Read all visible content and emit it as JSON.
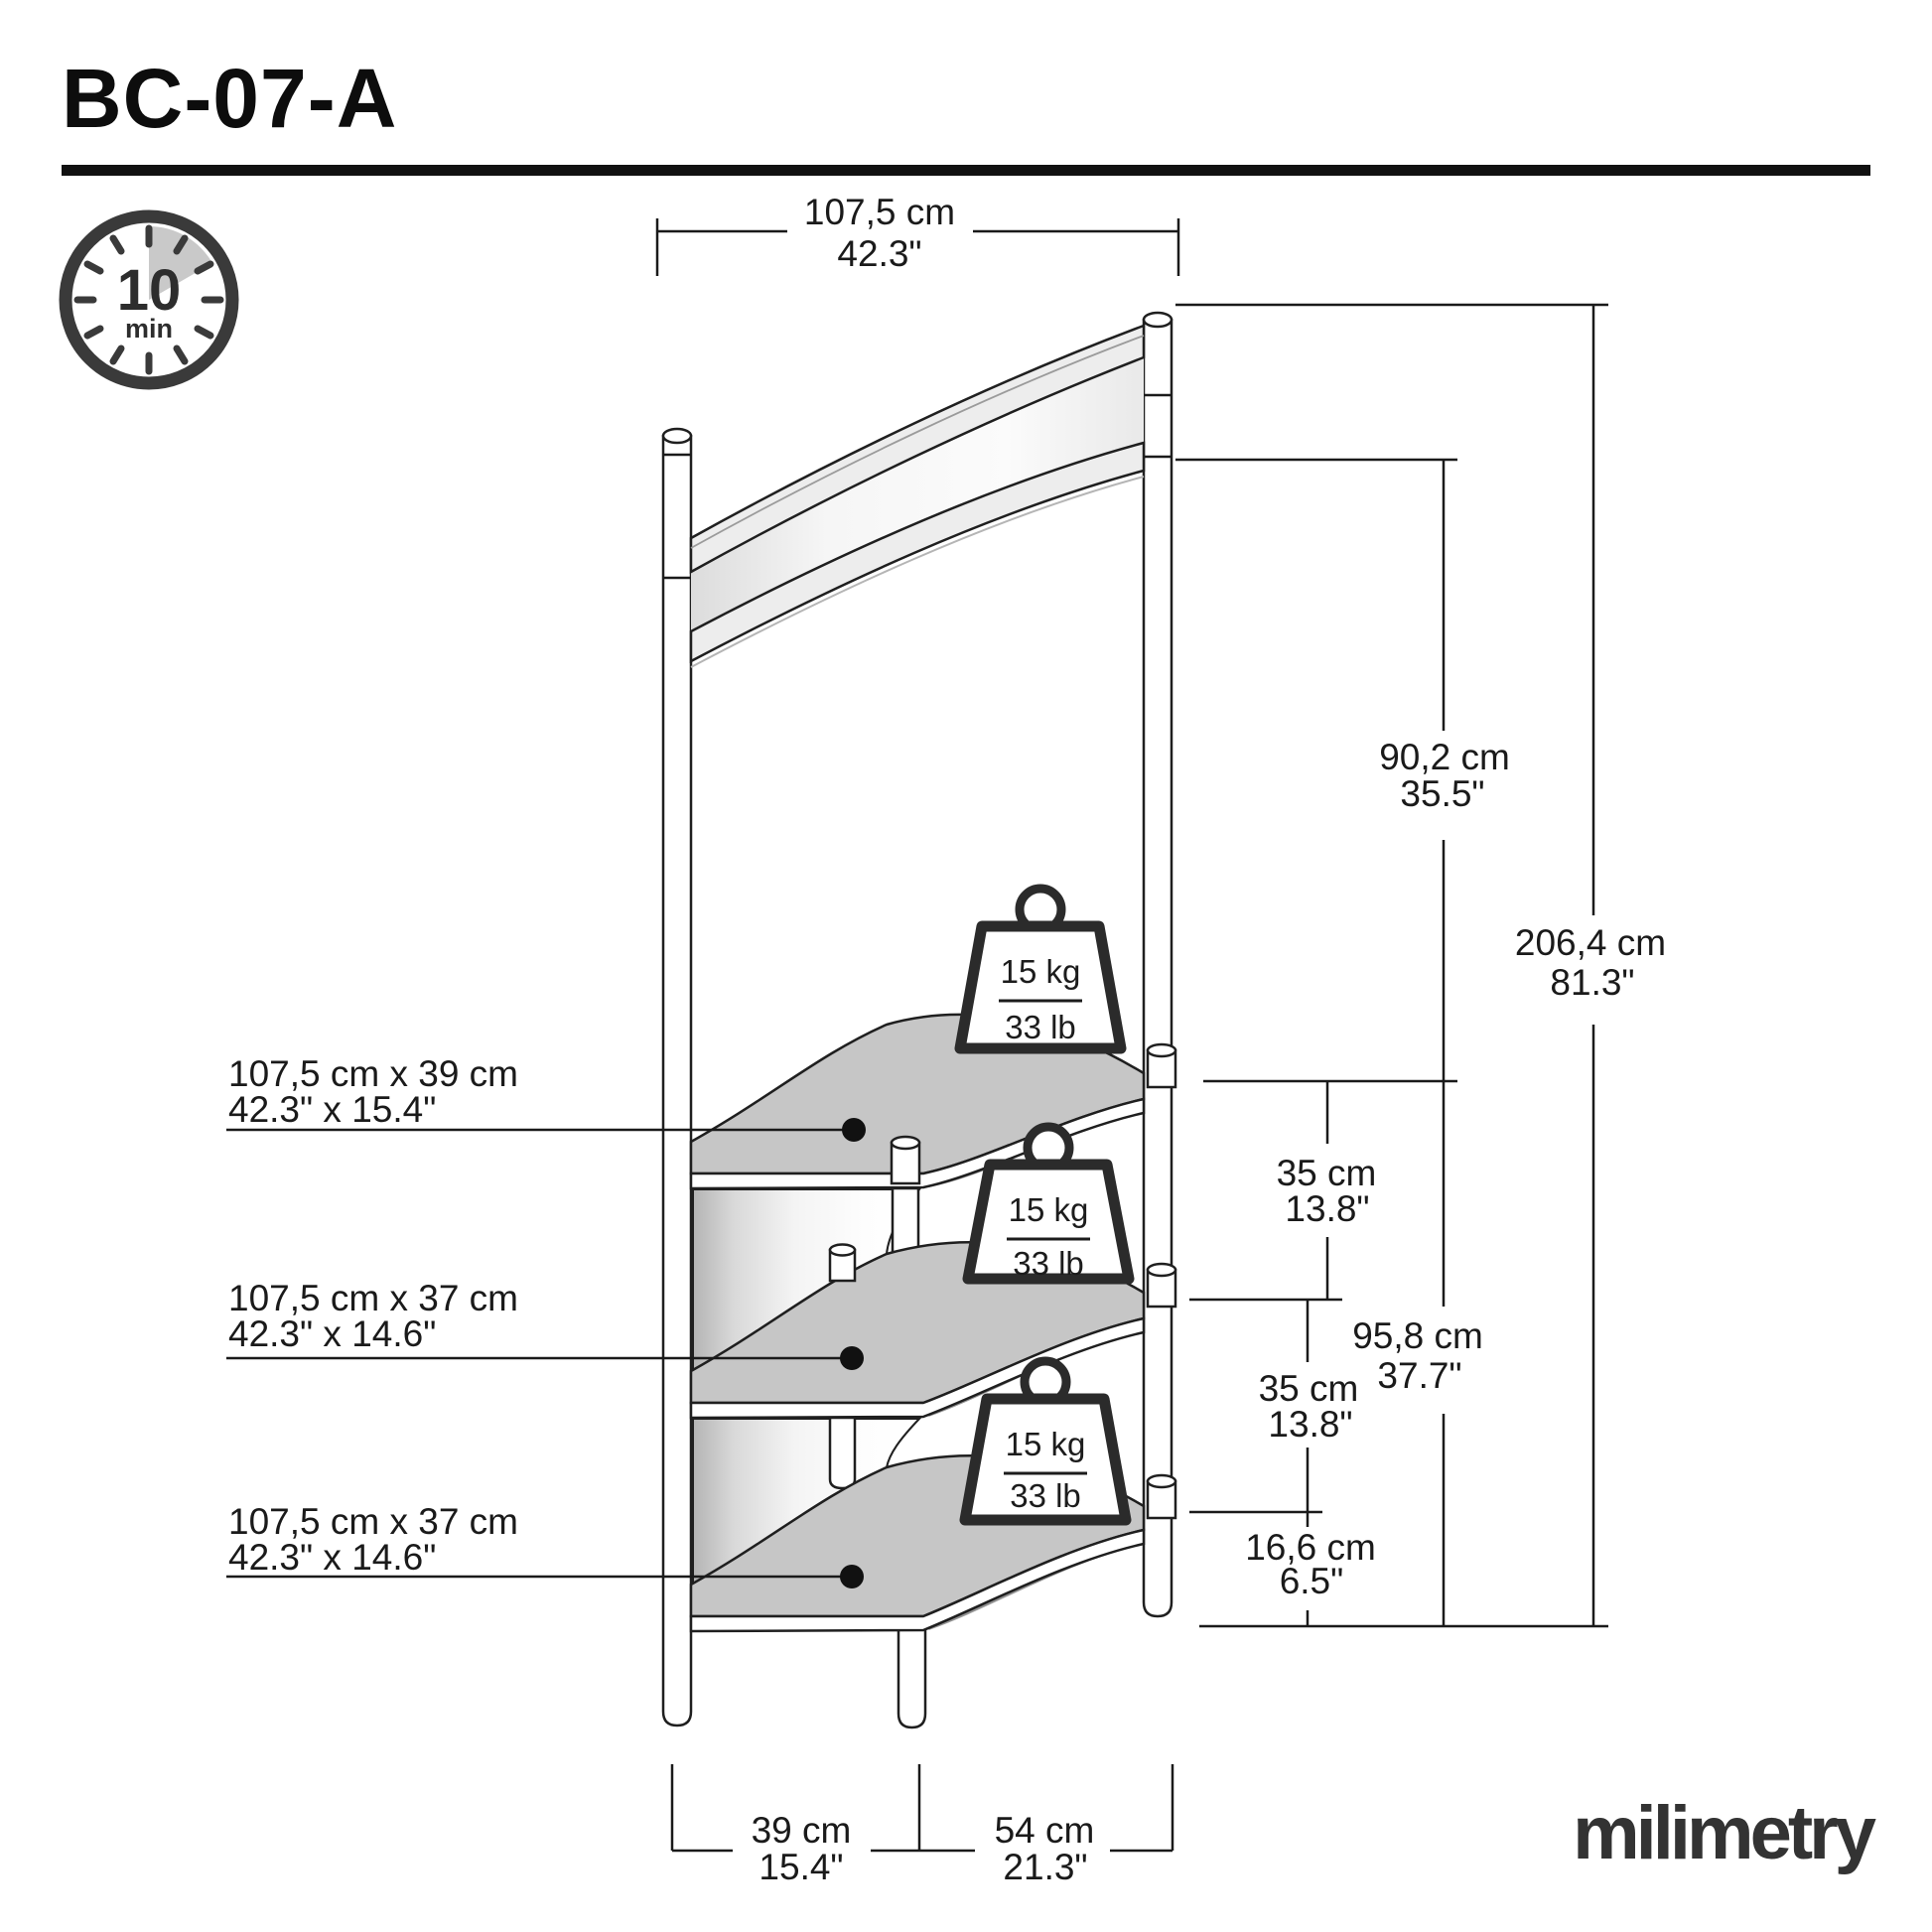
{
  "product": {
    "model": "BC-07-A"
  },
  "assembly_time": {
    "value": "10",
    "unit": "min"
  },
  "dims": {
    "width_top": {
      "cm": "107,5 cm",
      "in": "42.3\""
    },
    "height_upper": {
      "cm": "90,2 cm",
      "in": "35.5\""
    },
    "height_total": {
      "cm": "206,4 cm",
      "in": "81.3\""
    },
    "shelf_spacing_1": {
      "cm": "35 cm",
      "in": "13.8\""
    },
    "height_lower": {
      "cm": "95,8 cm",
      "in": "37.7\""
    },
    "shelf_spacing_2": {
      "cm": "35 cm",
      "in": "13.8\""
    },
    "bottom_clearance": {
      "cm": "16,6 cm",
      "in": "6.5\""
    },
    "base_depth": {
      "cm": "39 cm",
      "in": "15.4\""
    },
    "base_width": {
      "cm": "54 cm",
      "in": "21.3\""
    }
  },
  "shelves": [
    {
      "size_cm": "107,5 cm x 39 cm",
      "size_in": "42.3\" x 15.4\""
    },
    {
      "size_cm": "107,5 cm x 37 cm",
      "size_in": "42.3\" x 14.6\""
    },
    {
      "size_cm": "107,5 cm x 37 cm",
      "size_in": "42.3\" x 14.6\""
    }
  ],
  "weights": [
    {
      "kg": "15 kg",
      "lb": "33 lb"
    },
    {
      "kg": "15 kg",
      "lb": "33 lb"
    },
    {
      "kg": "15 kg",
      "lb": "33 lb"
    }
  ],
  "brand": {
    "logo": "milimetry"
  },
  "colors": {
    "line": "#1a1a1a",
    "shelf_gray": "#c6c6c6",
    "icon_dark": "#3a3a3a",
    "wedge_gray": "#c9c9c9"
  }
}
